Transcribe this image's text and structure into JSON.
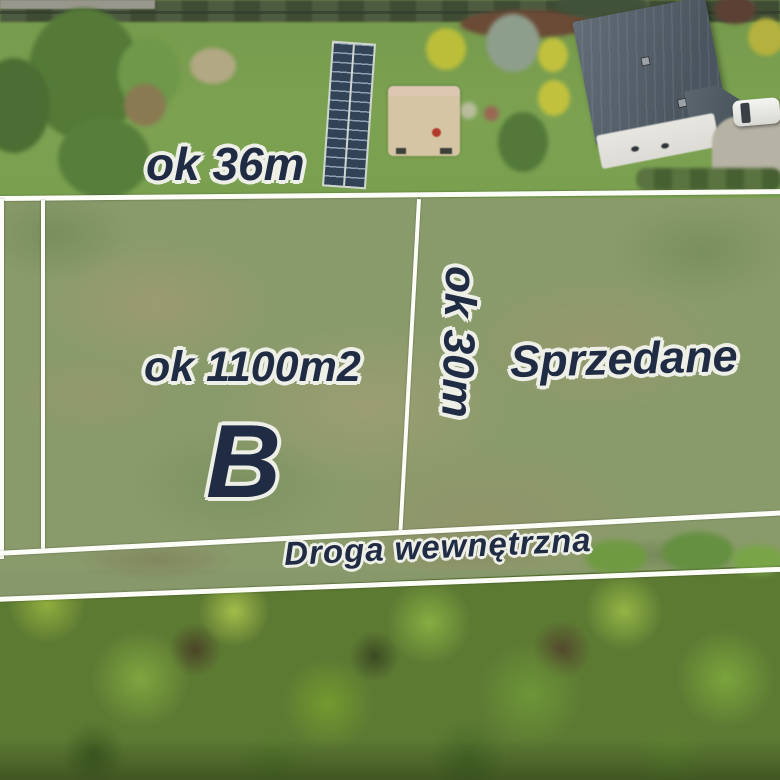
{
  "scene": {
    "type": "drone aerial photo of building plots for sale",
    "labels": {
      "top_width": "ok 36m",
      "area": "ok 1100m2",
      "plot_letter": "B",
      "side_depth": "ok 30m",
      "sold": "Sprzedane",
      "road": "Droga wewnętrzna"
    },
    "colors": {
      "label_fill": "#202b44",
      "label_halo": "#eef0e8",
      "boundary_line": "#fdfdf8",
      "roof_gray": "#515c66",
      "solar_panel_blue": "#324257"
    }
  }
}
